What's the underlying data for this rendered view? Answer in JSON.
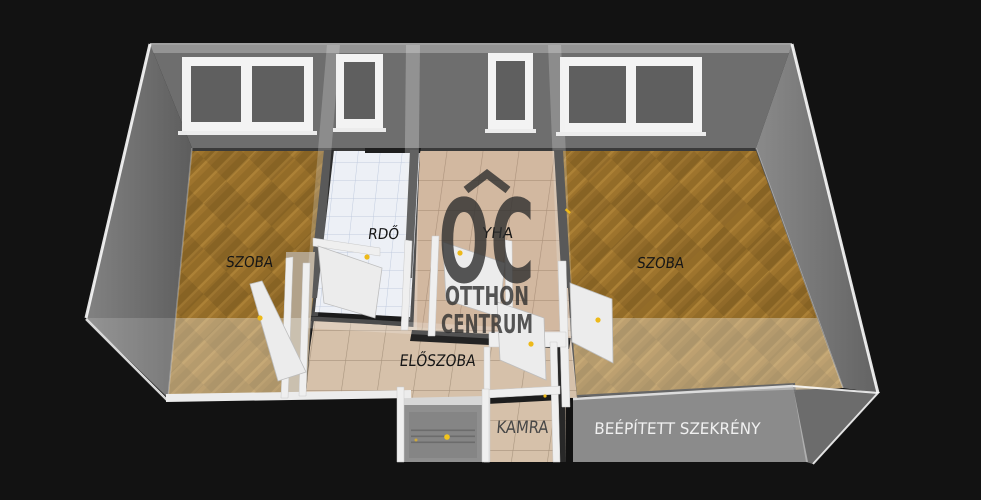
{
  "scene": {
    "background": "#121212"
  },
  "watermark": {
    "logo_text": "OC",
    "line1": "OTTHON",
    "line2": "CENTRUM",
    "color": "#2f2f2f"
  },
  "labels": {
    "room_left": "SZOBA",
    "bathroom_visible": "RDŐ",
    "kitchen_visible": "YHA",
    "room_right": "SZOBA",
    "hallway": "ELŐSZOBA",
    "pantry": "KAMRA",
    "built_in_closet": "BEÉPÍTETT SZEKRÉNY"
  },
  "colors": {
    "background": "#121212",
    "wall_gray": "#6e6e6e",
    "wood_floor": "#9e742d",
    "tile_floor": "#d6c1aa",
    "bath_floor": "#edf0f6",
    "window_frame": "#f3f3f3",
    "door_panel": "#ececec",
    "door_handle": "#edb919",
    "closet_wall": "#8b8b8b",
    "label_dark": "#161616",
    "label_light": "#f0f0f0",
    "watermark": "#2f2f2f"
  }
}
